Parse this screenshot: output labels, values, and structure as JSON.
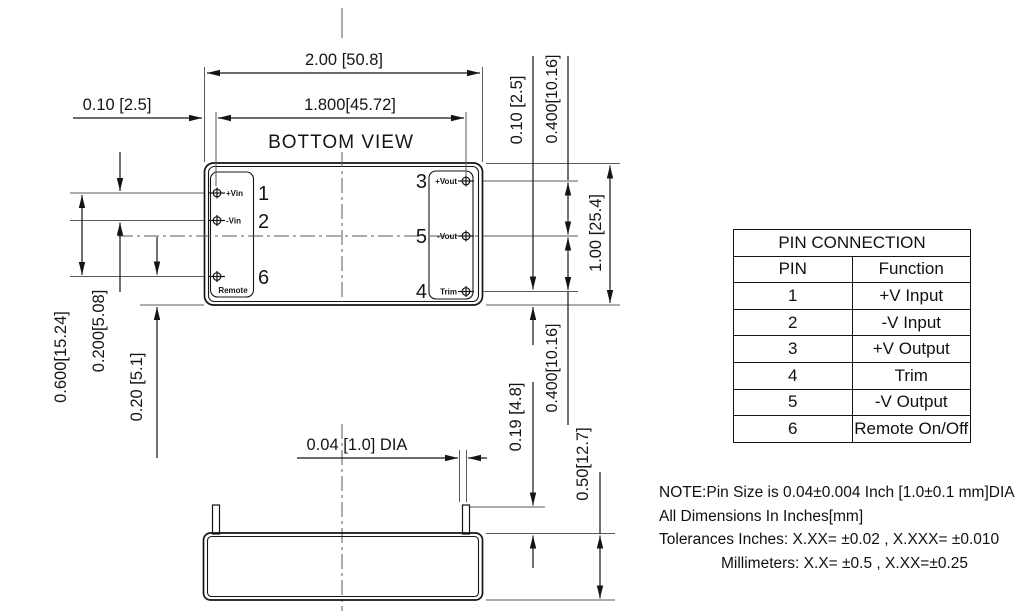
{
  "drawing": {
    "view_label": "BOTTOM VIEW",
    "dims": {
      "body_width": "2.00 [50.8]",
      "pin_row_span": "1.800[45.72]",
      "edge_to_pin": "0.10 [2.5]",
      "trim_to_edge": "0.10 [2.5]",
      "output_pitch_upper": "0.400[10.16]",
      "output_pitch_lower": "0.400[10.16]",
      "body_height": "1.00 [25.4]",
      "input_span": "0.600[15.24]",
      "input_pitch": "0.200[5.08]",
      "remote_to_edge": "0.20 [5.1]",
      "pin_length": "0.19 [4.8]",
      "case_height": "0.50[12.7]",
      "pin_dia": "0.04 [1.0] DIA"
    },
    "pins": {
      "left": [
        {
          "num": "1",
          "label": "+Vin"
        },
        {
          "num": "2",
          "label": "-Vin"
        },
        {
          "num": "6",
          "label": "Remote"
        }
      ],
      "right": [
        {
          "num": "3",
          "label": "+Vout"
        },
        {
          "num": "5",
          "label": "-Vout"
        },
        {
          "num": "4",
          "label": "Trim"
        }
      ]
    }
  },
  "table": {
    "title": "PIN CONNECTION",
    "headers": [
      "PIN",
      "Function"
    ],
    "rows": [
      [
        "1",
        "+V Input"
      ],
      [
        "2",
        "-V Input"
      ],
      [
        "3",
        "+V Output"
      ],
      [
        "4",
        "Trim"
      ],
      [
        "5",
        "-V Output"
      ],
      [
        "6",
        "Remote On/Off"
      ]
    ]
  },
  "notes": {
    "line1": "NOTE:Pin Size is 0.04±0.004 Inch [1.0±0.1 mm]DIA",
    "line2": "All Dimensions In Inches[mm]",
    "line3": "Tolerances Inches: X.XX= ±0.02 , X.XXX= ±0.010",
    "line4": "Millimeters: X.X= ±0.5 , X.XX=±0.25"
  },
  "colors": {
    "ink": "#141414",
    "thin_line": "#5a5a5a",
    "background": "#ffffff"
  }
}
